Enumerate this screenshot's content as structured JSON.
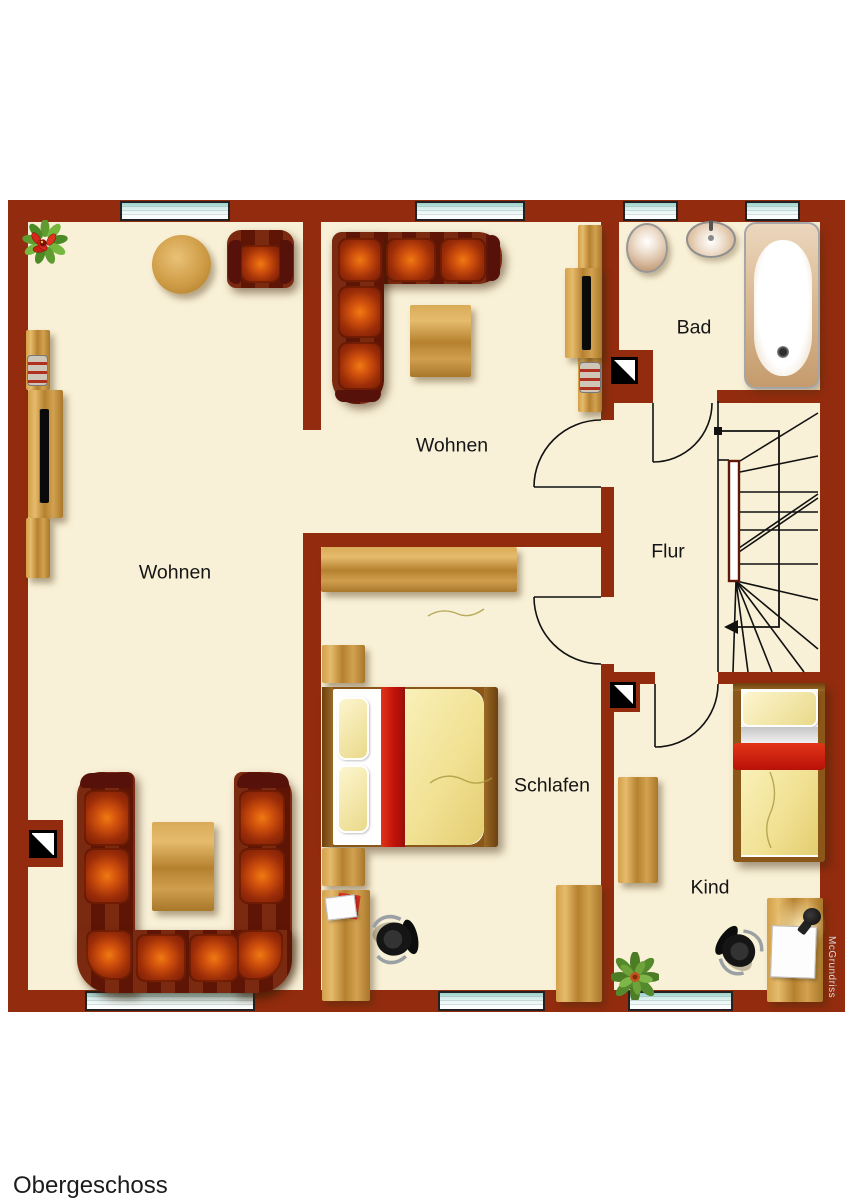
{
  "title": "Obergeschoss",
  "watermark": "McGrundriss",
  "rooms": {
    "living_left": {
      "label": "Wohnen"
    },
    "living_top": {
      "label": "Wohnen"
    },
    "bath": {
      "label": "Bad"
    },
    "hall": {
      "label": "Flur"
    },
    "bedroom": {
      "label": "Schlafen"
    },
    "child": {
      "label": "Kind"
    }
  },
  "colors": {
    "wall": "#932c0e",
    "floor": "#f9f1d7",
    "bg": "#ffffff",
    "line": "#1a1a1a",
    "wood": "#c8923c",
    "sofa": "#6b1a06",
    "accent": "#cc2012",
    "bedyellow": "#f3e7a2",
    "glass": "#a9d6d1"
  }
}
